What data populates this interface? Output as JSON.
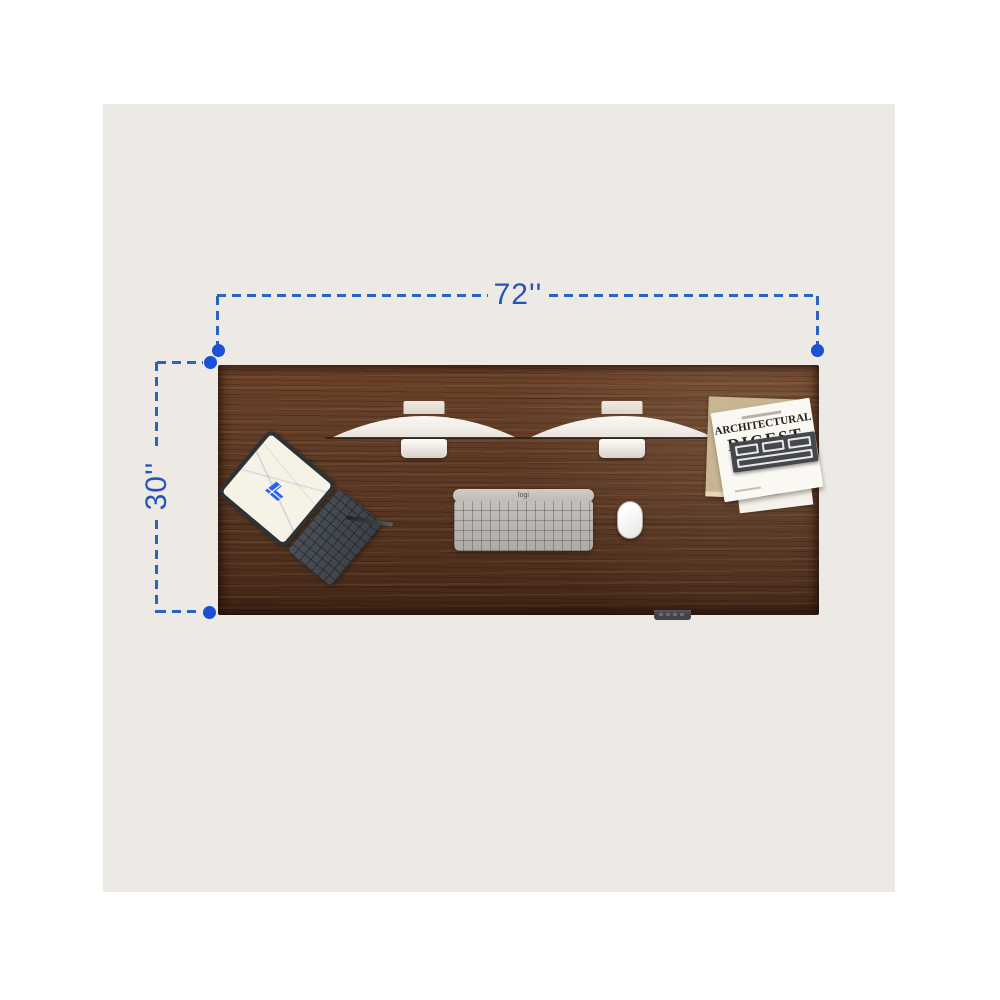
{
  "scene": {
    "background_color": "#ffffff",
    "stage_color": "#edeae5"
  },
  "dimensions": {
    "width_label": "72''",
    "height_label": "30''",
    "accent_color": "#2654bb"
  },
  "desk": {
    "description": "walnut desk top, top-down view",
    "wood_color": "#5d3a25"
  },
  "items": {
    "keyboard": {
      "brand": "logi"
    },
    "magazine": {
      "title_line1": "ARCHITECTURAL",
      "title_line2": "DIGEST"
    }
  }
}
